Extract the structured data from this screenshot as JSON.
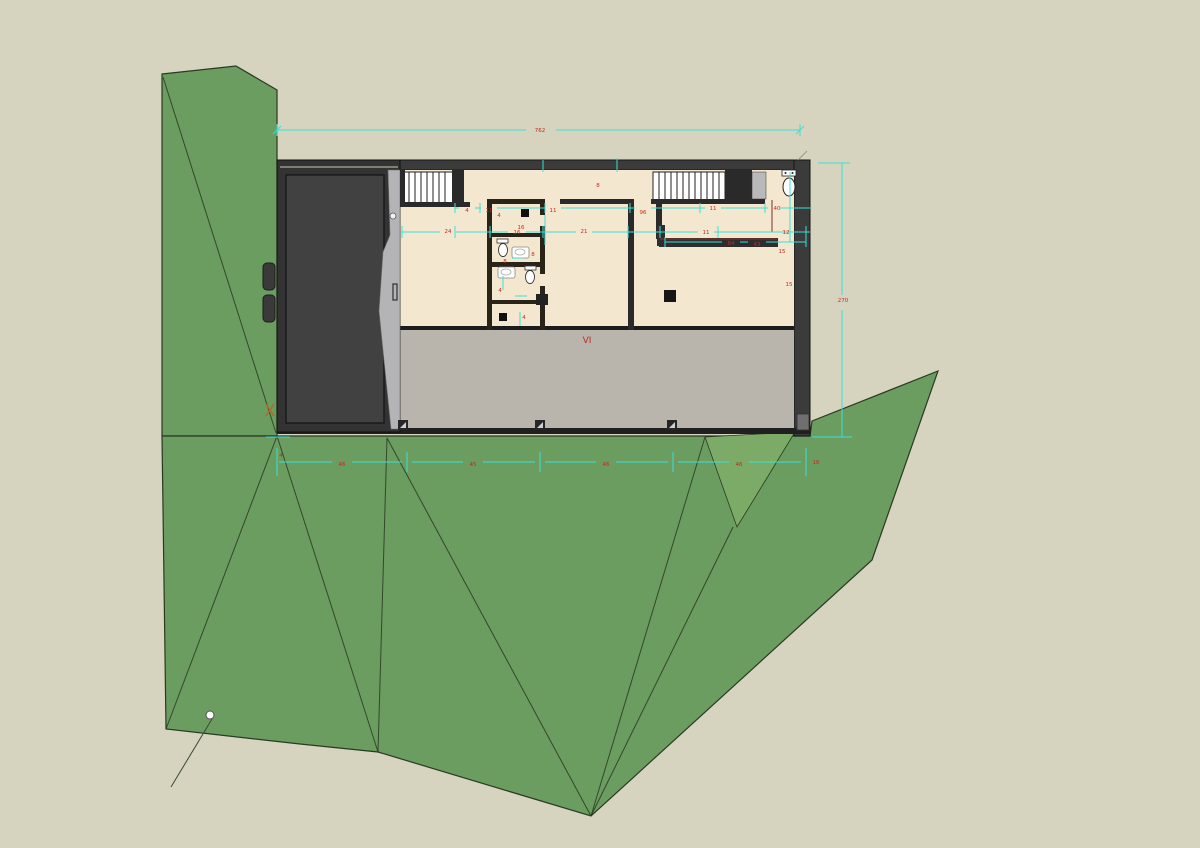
{
  "scene": {
    "view": "site-plan-with-floor-plan",
    "colors": {
      "background": "#d6d3bf",
      "terrain_green": "#6b9c60",
      "terrain_green_light": "#7cab68",
      "terrain_stroke": "#2a3a22",
      "wall_dark": "#3b3b3b",
      "floor_cream": "#f4e7cf",
      "slab_gray": "#b9b5ac",
      "garage_sliver_gray": "#b4b4b7",
      "dimension_cyan": "#3be0d6",
      "dimension_red": "#c22a21"
    },
    "labels": {
      "section_mark": "VI"
    },
    "dimension_labels": [
      {
        "x": 540,
        "y": 132,
        "t": "762"
      },
      {
        "x": 843,
        "y": 302,
        "t": "270"
      },
      {
        "x": 448,
        "y": 233,
        "t": "24"
      },
      {
        "x": 517,
        "y": 234,
        "t": "16"
      },
      {
        "x": 584,
        "y": 233,
        "t": "21"
      },
      {
        "x": 706,
        "y": 234,
        "t": "11"
      },
      {
        "x": 731,
        "y": 245,
        "t": "84"
      },
      {
        "x": 757,
        "y": 246,
        "t": "43"
      },
      {
        "x": 467,
        "y": 212,
        "t": "4"
      },
      {
        "x": 489,
        "y": 212,
        "t": "11"
      },
      {
        "x": 553,
        "y": 212,
        "t": "11"
      },
      {
        "x": 643,
        "y": 214,
        "t": "96"
      },
      {
        "x": 598,
        "y": 187,
        "t": "8"
      },
      {
        "x": 777,
        "y": 210,
        "t": "40"
      },
      {
        "x": 782,
        "y": 253,
        "t": "15"
      },
      {
        "x": 789,
        "y": 286,
        "t": "15"
      },
      {
        "x": 786,
        "y": 234,
        "t": "12"
      },
      {
        "x": 713,
        "y": 210,
        "t": "11"
      },
      {
        "x": 342,
        "y": 466,
        "t": "46"
      },
      {
        "x": 473,
        "y": 466,
        "t": "45"
      },
      {
        "x": 606,
        "y": 466,
        "t": "46"
      },
      {
        "x": 739,
        "y": 466,
        "t": "46"
      },
      {
        "x": 281,
        "y": 457,
        "t": "4"
      },
      {
        "x": 816,
        "y": 464,
        "t": "16"
      },
      {
        "x": 499,
        "y": 217,
        "t": "4"
      },
      {
        "x": 521,
        "y": 229,
        "t": "16"
      },
      {
        "x": 533,
        "y": 256,
        "t": "8"
      },
      {
        "x": 505,
        "y": 263,
        "t": "8"
      },
      {
        "x": 500,
        "y": 292,
        "t": "4"
      },
      {
        "x": 524,
        "y": 319,
        "t": "4"
      }
    ]
  }
}
